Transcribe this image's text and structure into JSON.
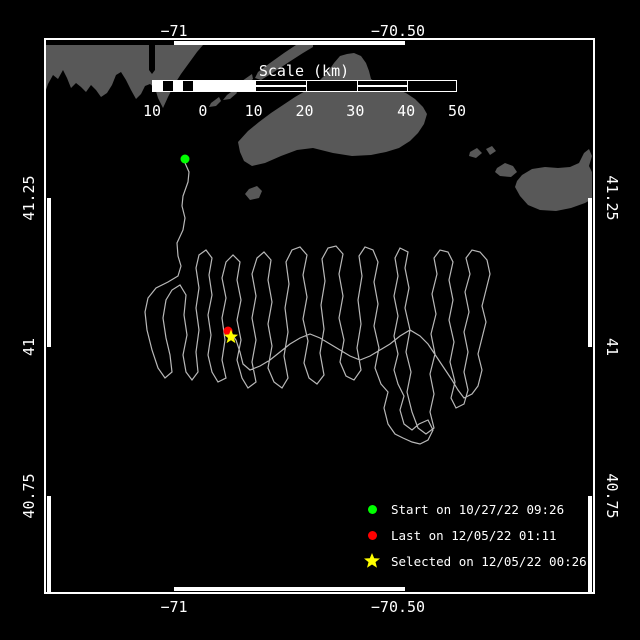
{
  "colors": {
    "background": "#000000",
    "frame": "#ffffff",
    "land": "#585858",
    "track": "#b8b8b8",
    "start": "#00ff00",
    "last": "#ff0000",
    "selected": "#ffff00",
    "text": "#ffffff"
  },
  "axes": {
    "lon": [
      "−71",
      "−70.50"
    ],
    "lat": [
      "41.25",
      "41",
      "40.75"
    ]
  },
  "scale_bar": {
    "title": "Scale (km)",
    "ticks": [
      "10",
      "0",
      "10",
      "20",
      "30",
      "40",
      "50"
    ]
  },
  "legend": {
    "items": [
      {
        "marker": "circle",
        "color": "#00ff00",
        "label": "Start on 10/27/22 09:26"
      },
      {
        "marker": "circle",
        "color": "#ff0000",
        "label": "Last on 12/05/22 01:11"
      },
      {
        "marker": "star",
        "color": "#ffff00",
        "label": "Selected on 12/05/22 00:26"
      }
    ]
  },
  "map": {
    "markers": {
      "start": {
        "x": 185,
        "y": 159,
        "color": "#00ff00"
      },
      "last": {
        "x": 228,
        "y": 331,
        "color": "#ff0000"
      },
      "selected": {
        "x": 231,
        "y": 337,
        "color": "#ffff00"
      }
    },
    "land": [
      {
        "name": "mainland-coast",
        "points": "46,45 149,45 149,70 152,74 155,70 155,45 203,45 197,52 189,63 181,74 174,85 168,97 163,108 158,98 155,88 150,84 145,86 141,94 136,99 131,90 126,80 121,72 116,75 112,85 107,93 101,97 96,90 91,85 86,92 81,87 76,83 71,88 67,78 63,70 58,79 53,75 48,84 46,90"
      },
      {
        "name": "elizabeth-island-1",
        "points": "296,45 313,45 313,47 303,53 289,62 274,72 261,80 255,78 258,72 270,63 284,53"
      },
      {
        "name": "elizabeth-island-2",
        "points": "252,74 242,81 238,87 245,86 253,79"
      },
      {
        "name": "elizabeth-island-3",
        "points": "235,89 227,95 223,100 230,99 237,93"
      },
      {
        "name": "elizabeth-island-4",
        "points": "219,97 211,103 209,107 216,106 221,101"
      },
      {
        "name": "marthas-vineyard",
        "points": "238,142 248,131 259,122 271,113 283,105 295,97 307,90 317,83 327,73 334,63 340,56 347,54 354,53 361,56 366,63 369,71 371,79 377,83 386,86 396,89 406,93 415,99 423,107 427,114 424,124 418,133 410,141 399,148 386,152 371,155 352,156 333,153 313,148 297,150 281,156 265,163 252,166 244,161 240,152"
      },
      {
        "name": "small-island-south",
        "points": "249,189 257,186 262,191 259,198 250,200 245,194"
      },
      {
        "name": "islet-west-1",
        "points": "470,152 477,148 482,153 476,158 469,156"
      },
      {
        "name": "islet-west-2",
        "points": "486,149 492,146 496,151 490,155"
      },
      {
        "name": "tuckernuck-island",
        "points": "497,168 505,163 513,166 517,172 511,177 500,176 495,172"
      },
      {
        "name": "nantucket-island",
        "points": "517,181 522,175 532,169 545,167 558,168 570,167 579,163 584,153 589,149 592,156 589,166 592,172 592,199 585,203 571,208 556,211 540,210 528,205 520,196 515,187"
      }
    ],
    "track": {
      "points": "185,163 189,172 188,182 183,196 182,206 185,218 183,230 177,243 178,256 181,266 178,276 168,282 156,288 148,298 145,312 147,330 152,350 158,368 165,378 172,372 170,355 166,338 163,318 166,300 172,290 180,285 186,295 184,315 187,335 183,355 186,372 192,380 198,372 196,352 199,330 196,308 199,288 196,268 199,255 206,250 212,258 209,275 212,295 208,315 211,335 208,355 212,372 218,382 226,378 222,360 225,340 222,318 226,298 222,278 226,262 233,255 240,262 237,280 241,300 237,320 241,340 237,360 242,378 248,388 256,382 252,362 256,340 252,318 256,296 252,274 257,258 264,252 271,260 268,280 272,302 268,324 272,346 268,368 274,382 282,388 288,378 284,356 288,332 285,308 289,284 286,262 292,250 300,247 307,255 303,275 307,297 303,319 308,341 304,363 309,378 317,384 324,375 320,353 324,329 321,305 325,281 322,259 328,248 336,246 343,254 339,274 343,296 339,318 344,340 340,362 346,376 354,380 361,370 357,348 361,324 358,300 362,276 359,256 365,247 373,250 378,262 374,282 378,304 374,326 379,348 375,368 381,384 388,392 384,408 388,424 395,434 403,438 412,442 420,444 428,440 433,430 428,420 419,424 412,430 404,424 400,410 404,396 398,384 394,370 398,354 394,336 398,316 394,296 398,276 395,258 400,248 408,252 405,268 409,288 405,308 410,330 406,352 411,372 407,392 412,412 418,428 426,434 434,428 430,412 434,394 430,374 435,354 431,334 436,314 432,294 437,274 434,258 440,250 448,252 453,262 449,280 453,300 449,320 454,342 450,362 455,382 451,398 456,408 464,404 468,390 464,372 468,352 464,332 469,312 465,292 470,274 466,258 472,250 480,252 487,260 490,274 486,290 482,306 486,322 482,338 478,354 482,370 478,386 472,394 464,398 458,390 452,380 444,368 436,356 428,344 420,336 410,330 400,336 390,344 380,350 370,356 360,360 350,356 340,350 330,344 320,338 310,334 300,338 290,344 280,352 270,360 260,366 250,370 243,364 240,352 236,340 231,333"
    }
  }
}
